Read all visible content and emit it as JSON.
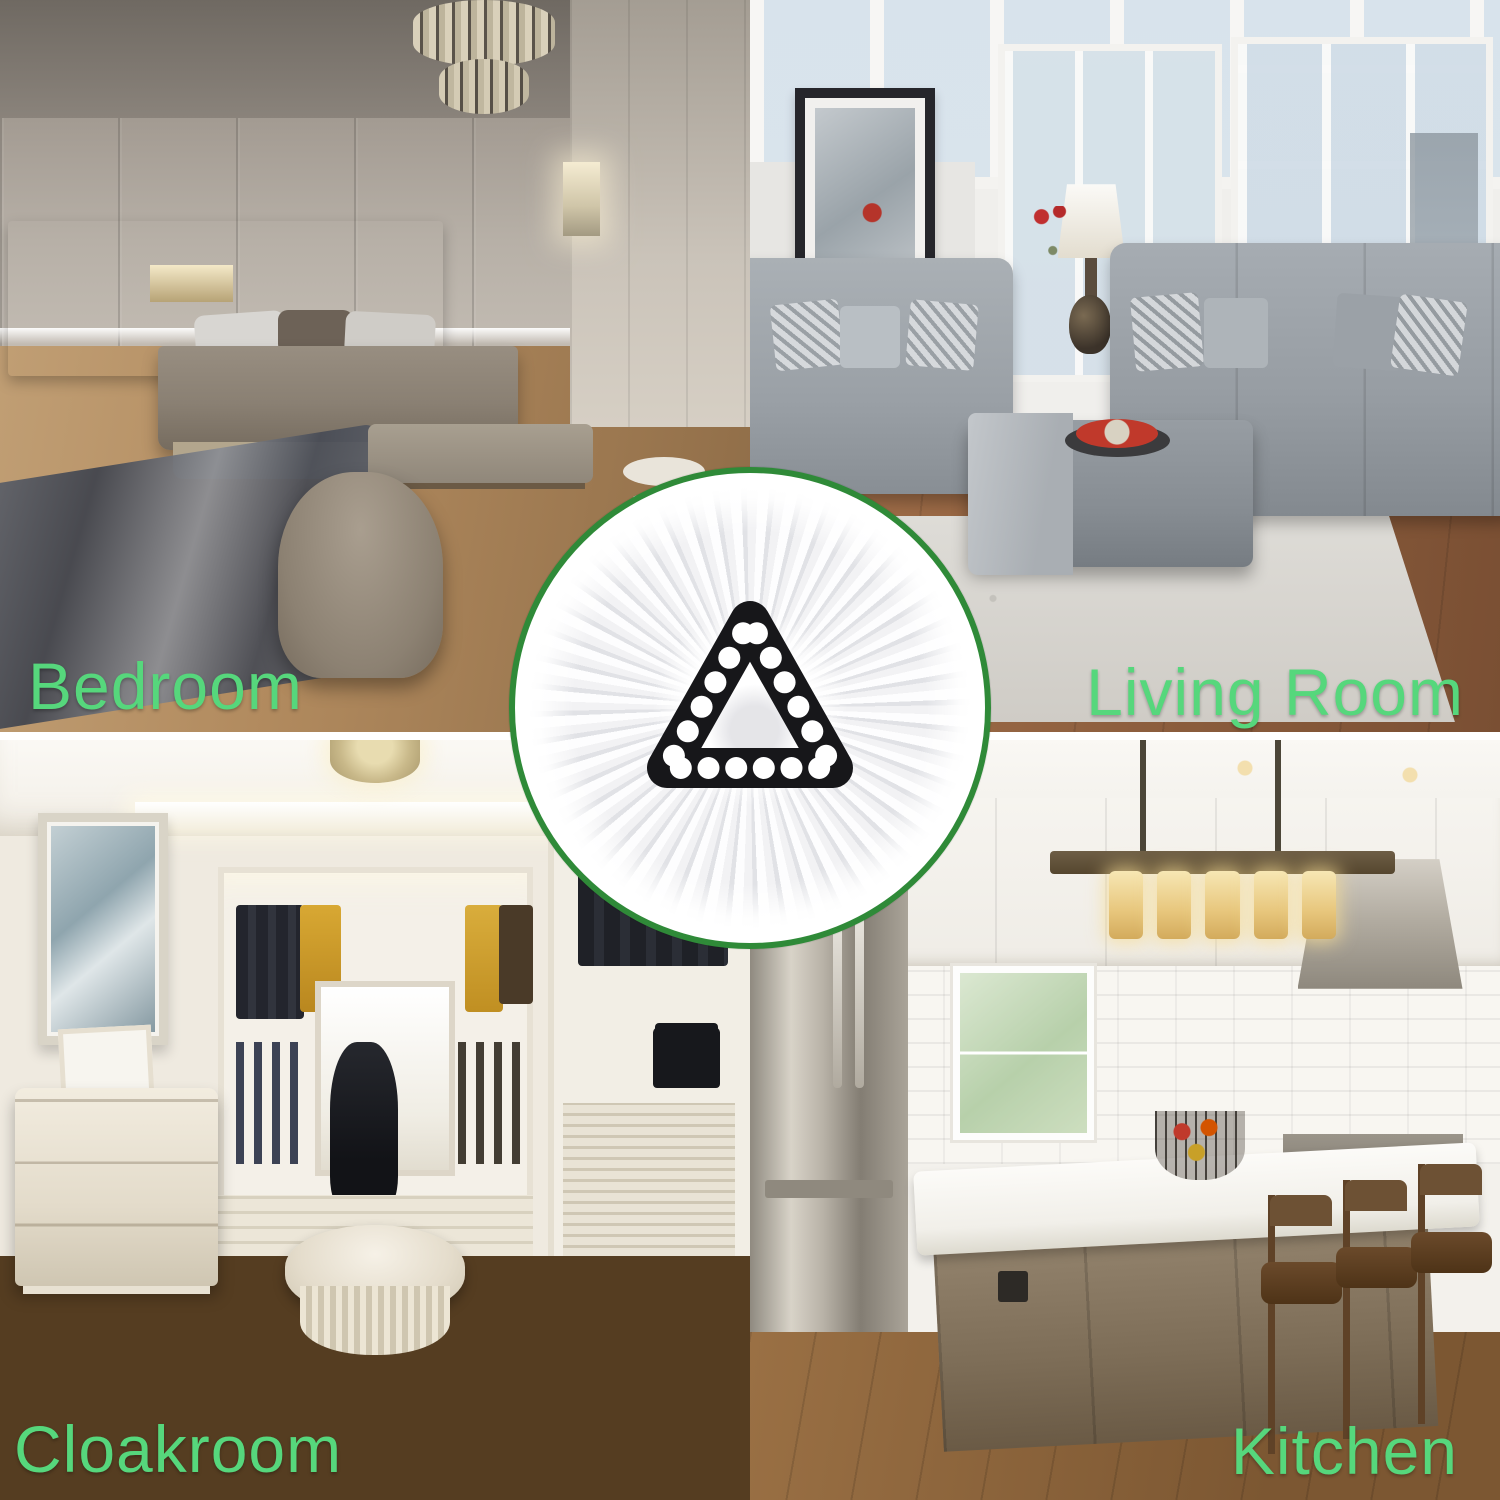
{
  "page": {
    "title": "Spin mop replacement head — suitable rooms collage"
  },
  "colors": {
    "label_green": "#56d77c",
    "badge_ring_green": "#2f8a38",
    "hub_black": "#17171a",
    "mop_white": "#ffffff",
    "seam_white": "#ffffff"
  },
  "quadrants": [
    {
      "id": "bedroom",
      "label": "Bedroom",
      "position": "top-left"
    },
    {
      "id": "living_room",
      "label": "Living Room",
      "position": "top-right"
    },
    {
      "id": "cloakroom",
      "label": "Cloakroom",
      "position": "bottom-left"
    },
    {
      "id": "kitchen",
      "label": "Kitchen",
      "position": "bottom-right"
    }
  ],
  "center_badge": {
    "icon": "spin-mop-head-icon",
    "description_shape": "white microfiber mop head with black rounded-triangle connector",
    "hub_hole_count": 18,
    "strand_spokes": 48
  }
}
